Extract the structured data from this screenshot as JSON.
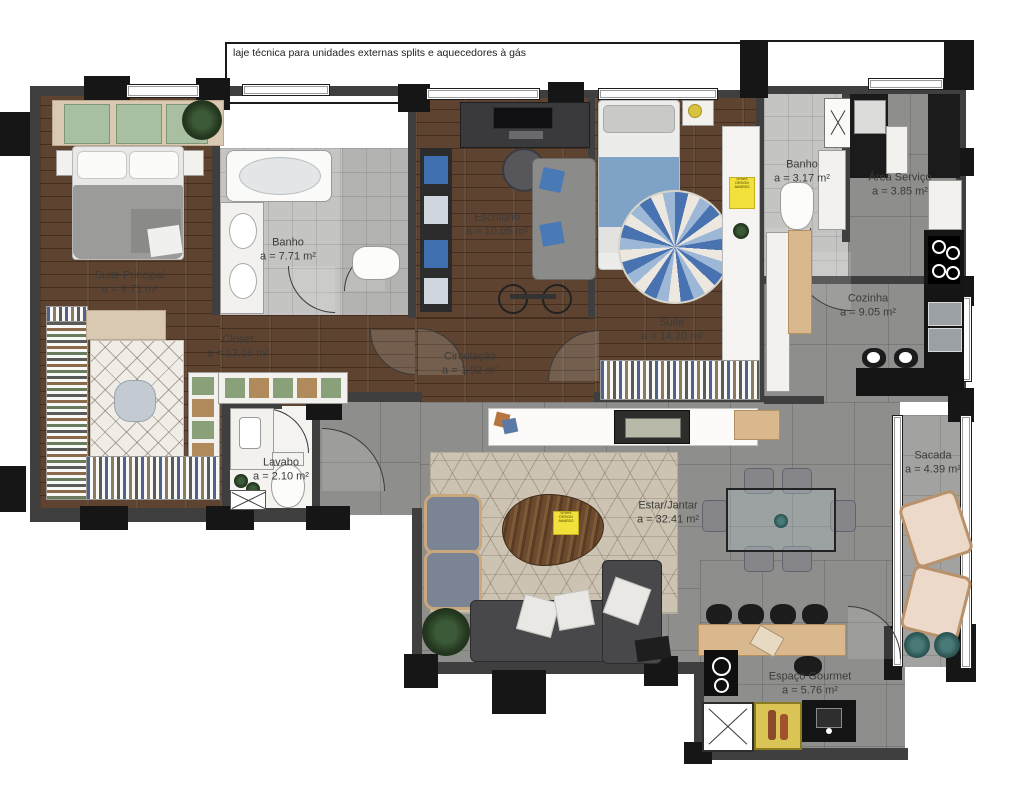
{
  "plan": {
    "note_laje": "laje técnica para unidades externas splits e aquecedores à gás",
    "badge_text": "SPARK DESIGN AWARDS"
  },
  "rooms": [
    {
      "id": "suite-principal",
      "name": "Suite Principal",
      "area": "a = 9.71 m²"
    },
    {
      "id": "banho-suite",
      "name": "Banho",
      "area": "a = 7.71 m²"
    },
    {
      "id": "escritorio",
      "name": "Escritório",
      "area": "a = 10.05 m²"
    },
    {
      "id": "suite",
      "name": "Suite",
      "area": "a = 14.20 m²"
    },
    {
      "id": "banho",
      "name": "Banho",
      "area": "a = 3.17 m²"
    },
    {
      "id": "area-servico",
      "name": "Área Serviço",
      "area": "a = 3.85 m²"
    },
    {
      "id": "cozinha",
      "name": "Cozinha",
      "area": "a = 9.05 m²"
    },
    {
      "id": "closet",
      "name": "Closet",
      "area": "a = 13.16 m²"
    },
    {
      "id": "circulacao",
      "name": "Circulação",
      "area": "a = 1.92 m²"
    },
    {
      "id": "lavabo",
      "name": "Lavabo",
      "area": "a = 2.10 m²"
    },
    {
      "id": "estar-jantar",
      "name": "Estar/Jantar",
      "area": "a = 32.41 m²"
    },
    {
      "id": "sacada",
      "name": "Sacada",
      "area": "a = 4.39 m²"
    },
    {
      "id": "espaco-gourmet",
      "name": "Espaço Gourmet",
      "area": "a = 5.76 m²"
    }
  ]
}
